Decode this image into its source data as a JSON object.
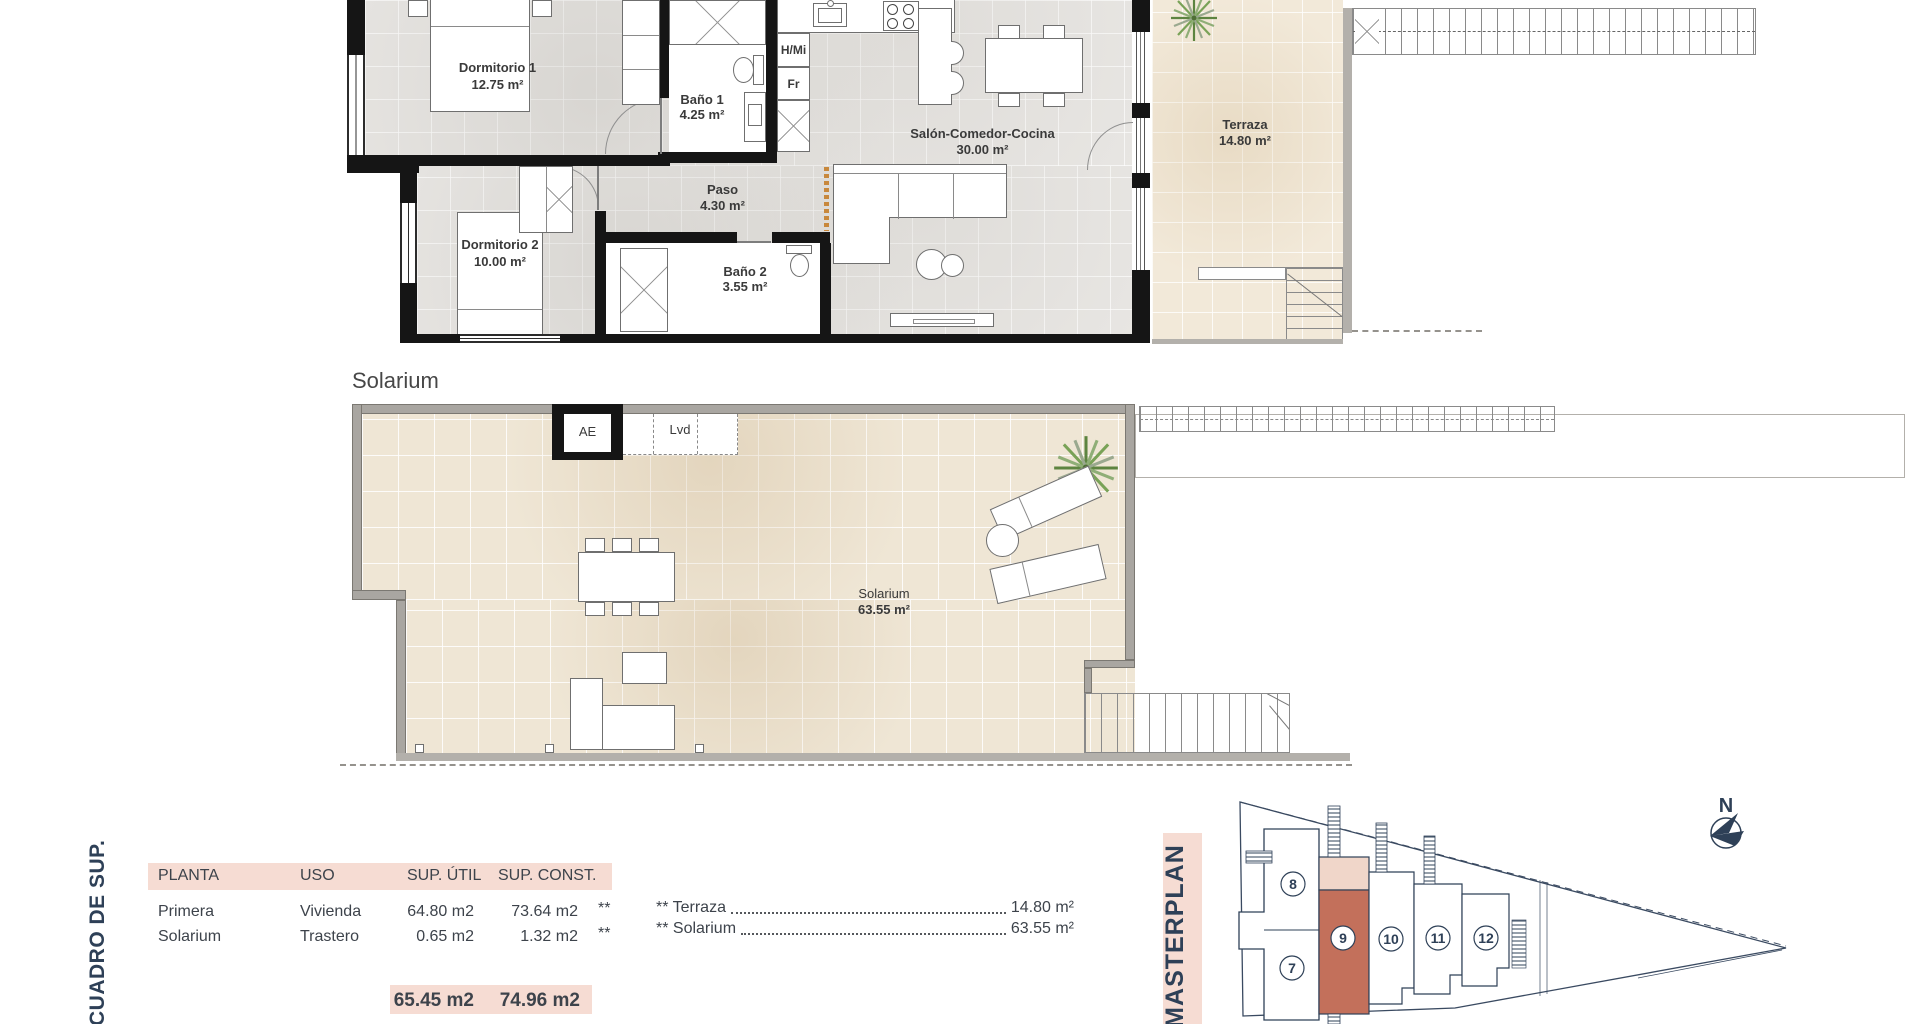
{
  "plan_first": {
    "rooms": [
      {
        "name": "Dormitorio 1",
        "area": "12.75 m²"
      },
      {
        "name": "Baño 1",
        "area": "4.25 m²"
      },
      {
        "name": "Paso",
        "area": "4.30 m²"
      },
      {
        "name": "Dormitorio 2",
        "area": "10.00 m²"
      },
      {
        "name": "Baño 2",
        "area": "3.55 m²"
      },
      {
        "name": "Salón-Comedor-Cocina",
        "area": "30.00 m²"
      },
      {
        "name": "Terraza",
        "area": "14.80 m²"
      }
    ],
    "appliances": {
      "hmi": "H/Mi",
      "fr": "Fr"
    }
  },
  "plan_solarium": {
    "heading": "Solarium",
    "labels": {
      "ae": "AE",
      "lvd": "Lvd"
    },
    "room": {
      "name": "Solarium",
      "area": "63.55 m²"
    }
  },
  "summary_table": {
    "title": "CUADRO DE SUP.",
    "headers": [
      "PLANTA",
      "USO",
      "SUP. ÚTIL",
      "SUP. CONST."
    ],
    "rows": [
      {
        "planta": "Primera",
        "uso": "Vivienda",
        "util": "64.80 m2",
        "const": "73.64 m2",
        "mark": "**"
      },
      {
        "planta": "Solarium",
        "uso": "Trastero",
        "util": "0.65 m2",
        "const": "1.32 m2",
        "mark": "**"
      }
    ],
    "totals": {
      "util": "65.45 m2",
      "const": "74.96 m2"
    },
    "annotations": [
      {
        "label": "** Terraza",
        "value": "14.80 m²"
      },
      {
        "label": "** Solarium",
        "value": "63.55 m²"
      }
    ]
  },
  "masterplan": {
    "title": "MASTERPLAN",
    "north": "N",
    "highlighted_unit": "9",
    "units": [
      {
        "number": "7"
      },
      {
        "number": "8"
      },
      {
        "number": "9"
      },
      {
        "number": "10"
      },
      {
        "number": "11"
      },
      {
        "number": "12"
      }
    ]
  },
  "colors": {
    "accent_pink": "#f6dcd3",
    "unit_highlight": "#c3705b",
    "unit_highlight_light": "#f0d6c9",
    "navy_text": "#2e4057",
    "plan_label": "#3a3a3a",
    "wall_black": "#151515",
    "wall_gray": "#a9a6a1",
    "floor_gray": "#e8e6e3",
    "floor_beige": "#f2e9d9"
  }
}
